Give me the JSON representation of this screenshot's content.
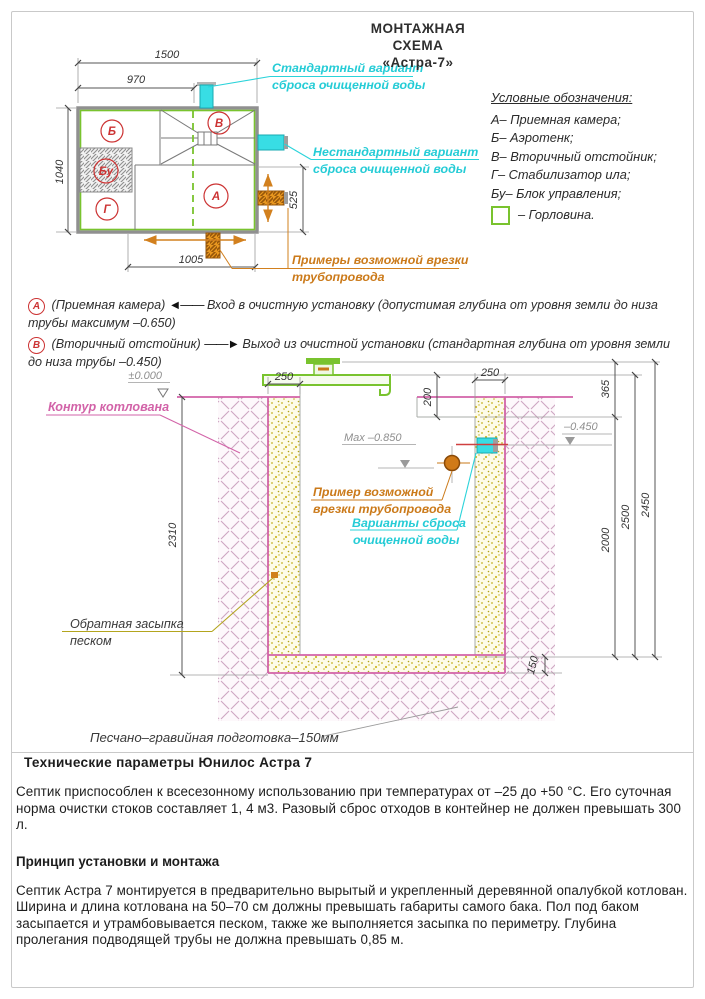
{
  "title": {
    "line1": "МОНТАЖНАЯ СХЕМА",
    "line2": "«Астра-7»"
  },
  "legend": {
    "title": "Условные обозначения:",
    "items": [
      "А– Приемная камера;",
      "Б– Аэротенк;",
      "В– Вторичный отстойник;",
      "Г– Стабилизатор ила;",
      "Бу– Блок управления;",
      "– Горловина."
    ]
  },
  "plan": {
    "dims": {
      "width": "1500",
      "inlet": "970",
      "height": "1040",
      "outlet": "525",
      "bottom": "1005"
    },
    "chambers": {
      "a": "А",
      "b": "Б",
      "v": "В",
      "g": "Г",
      "bu": "Бу"
    },
    "labels": {
      "standard": [
        "Стандартный вариант",
        "сброса очищенной воды"
      ],
      "nonstandard": [
        "Нестандартный вариант",
        "сброса очищенной воды"
      ],
      "examples": [
        "Примеры возможной врезки",
        "трубопровода"
      ]
    }
  },
  "notes": [
    {
      "badge": "А",
      "chamber": "(Приемная камера)",
      "arrow": "◄——",
      "text": "Вход в очистную установку (допустимая глубина от уровня земли до низа трубы максимум –0.650)"
    },
    {
      "badge": "В",
      "chamber": "(Вторичный отстойник)",
      "arrow": "——►",
      "text": "Выход из очистной установки (стандартная глубина от уровня земли до низа трубы –0.450)"
    }
  ],
  "section": {
    "levels": {
      "zero": "±0.000",
      "max": "Max –0.850",
      "outlet": "–0.450"
    },
    "dims": {
      "left250": "250",
      "right250": "250",
      "neck200": "200",
      "top365": "365",
      "depth2310": "2310",
      "d2000": "2000",
      "d2500": "2500",
      "d2450": "2450",
      "bed150": "150"
    },
    "labels": {
      "contour": "Контур котлована",
      "example": [
        "Пример возможной",
        "врезки трубопровода"
      ],
      "discharge": [
        "Варианты сброса",
        "очищенной воды"
      ],
      "backfill": [
        "Обратная засыпка",
        "песком"
      ],
      "bed": "Песчано–гравийная подготовка–150мм"
    }
  },
  "specs": {
    "title": "Технические параметры Юнилос Астра 7",
    "p1": "Септик приспособлен к всесезонному использованию при температурах от –25 до +50 °С. Его суточная норма очистки стоков составляет 1, 4 м3. Разовый сброс отходов в контейнер не должен превышать 300 л.",
    "subtitle": "Принцип установки и монтажа",
    "p2": "Септик Астра 7 монтируется в предварительно вырытый и укрепленный деревянной опалубкой котлован. Ширина и длина котлована на 50–70 см должны превышать габариты самого бака. Пол под баком засыпается и утрамбовывается песком, также же выполняется засыпка по периметру. Глубина пролегания подводящей трубы не должна превышать 0,85 м."
  },
  "colors": {
    "cyan": "#2bd3da",
    "orange": "#cf7d1c",
    "green": "#79c32e",
    "magenta": "#d263a8",
    "red": "#cc3333"
  }
}
